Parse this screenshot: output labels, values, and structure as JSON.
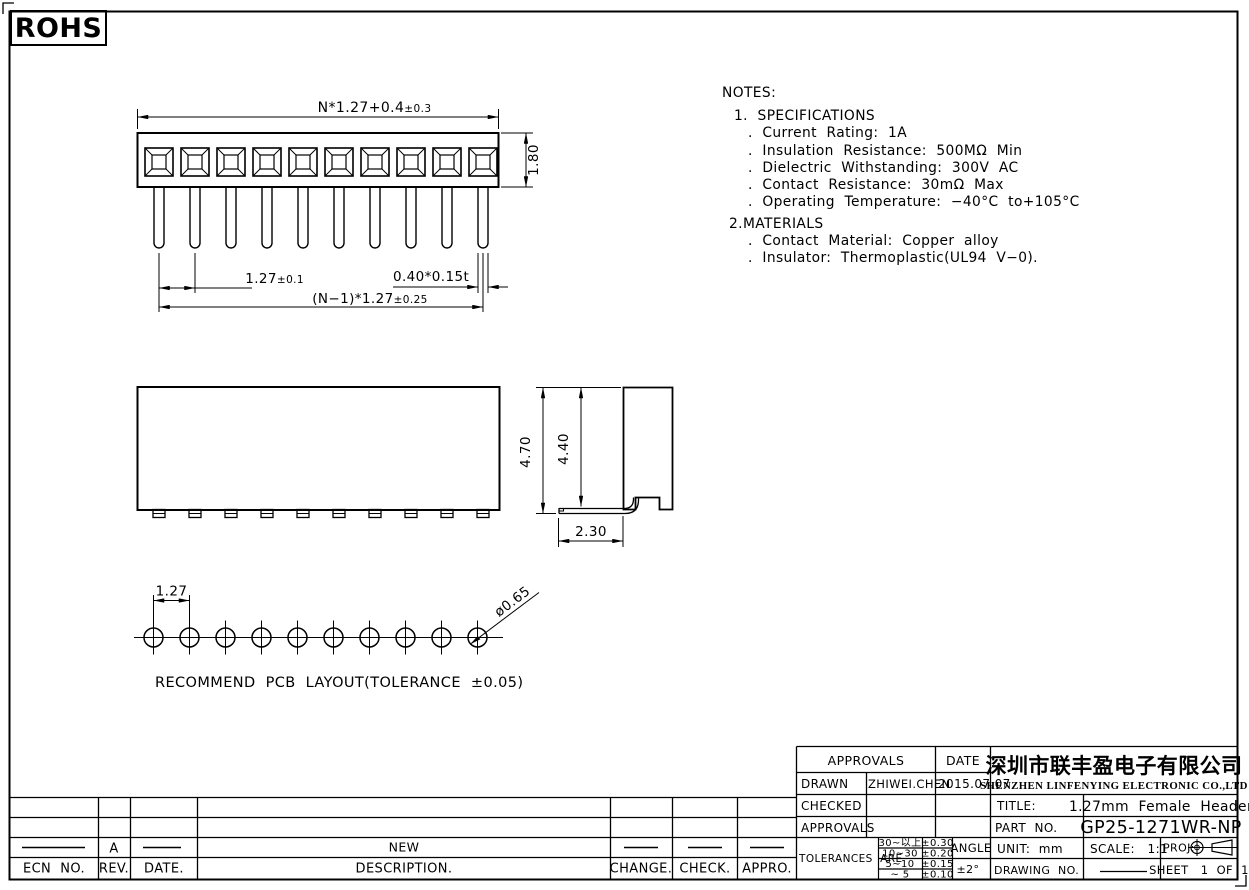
{
  "logo": {
    "text": "ROHS"
  },
  "notes": {
    "title": "NOTES:",
    "lines": [
      "1.  SPECIFICATIONS",
      ".  Current  Rating:  1A",
      ".  Insulation  Resistance:  500MΩ  Min",
      ".  Dielectric  Withstanding:  300V  AC",
      ".  Contact  Resistance:  30mΩ  Max",
      ".  Operating  Temperature:  −40°C  to+105°C",
      "2.MATERIALS",
      ".  Contact  Material:  Copper  alloy",
      ".  Insulator:  Thermoplastic(UL94  V−0)."
    ]
  },
  "top_view": {
    "dim_overall": "N*1.27+0.4",
    "dim_overall_tol": "±0.3",
    "dim_height": "1.80",
    "dim_pitch": "1.27",
    "dim_pitch_tol": "±0.1",
    "dim_span": "(N−1)*1.27",
    "dim_span_tol": "±0.25",
    "dim_pin": "0.40*0.15t"
  },
  "side_view": {
    "dim_total": "4.70",
    "dim_body": "4.40",
    "dim_lead": "2.30"
  },
  "pcb": {
    "dim_pitch": "1.27",
    "dim_hole": "ø0.65",
    "caption": "RECOMMEND  PCB  LAYOUT(TOLERANCE  ±0.05)"
  },
  "title_block": {
    "approvals_header": "APPROVALS",
    "date_header": "DATE",
    "rows": [
      {
        "label": "DRAWN",
        "name": "ZHIWEI.CHEN",
        "date": "2015.07.07"
      },
      {
        "label": "CHECKED",
        "name": "",
        "date": ""
      },
      {
        "label": "APPROVALS",
        "name": "",
        "date": ""
      }
    ],
    "tolerances_label": "TOLERANCES  ARE",
    "tolerance_rows": [
      {
        "range": "30~以上",
        "value": "±0.30"
      },
      {
        "range": "10~30",
        "value": "±0.20"
      },
      {
        "range": "5~10",
        "value": "±0.15"
      },
      {
        "range": "~ 5",
        "value": "±0.10"
      }
    ],
    "angle_label": "ANGLE",
    "angle_value": "±2°",
    "company_cn": "深圳市联丰盈电子有限公司",
    "company_en": "SHENZHEN LINFENYING ELECTRONIC CO.,LTD",
    "title_label": "TITLE:",
    "title_value": "1.27mm  Female  Header",
    "part_label": "PART  NO.",
    "part_value": "GP25-1271WR-NP",
    "unit_label": "UNIT:  mm",
    "scale_label": "SCALE:   1:1",
    "proj_label": "PROJ:",
    "drawing_label": "DRAWING  NO.",
    "sheet_label": "SHEET   1  OF  1"
  },
  "revision": {
    "headers": [
      "ECN  NO.",
      "REV.",
      "DATE.",
      "DESCRIPTION.",
      "CHANGE.",
      "CHECK.",
      "APPRO."
    ],
    "rev_value": "A",
    "description_value": "NEW"
  }
}
